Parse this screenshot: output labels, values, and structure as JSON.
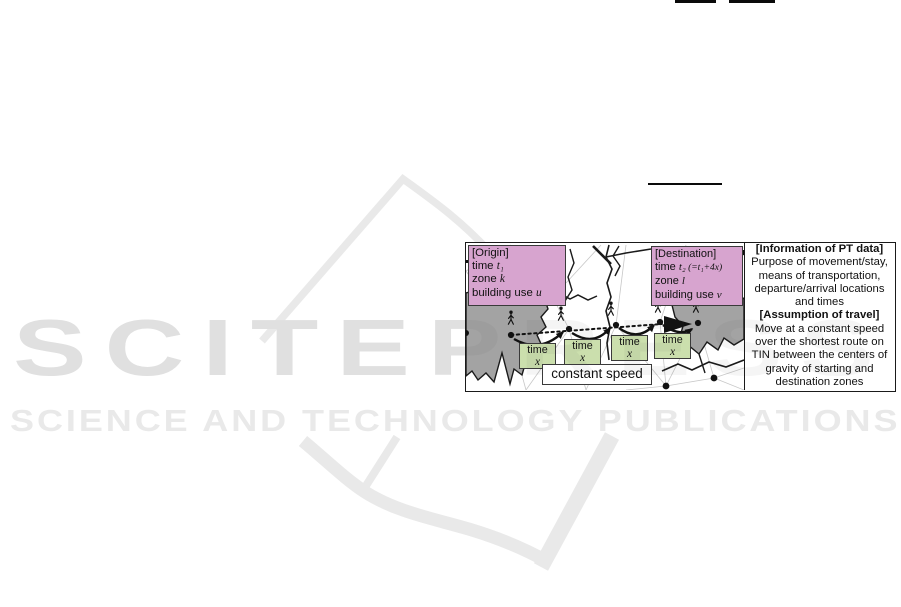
{
  "watermark": {
    "title": "SCITEPRESS",
    "subtitle": "SCIENCE AND TECHNOLOGY PUBLICATIONS",
    "color": "#e9e9e9"
  },
  "figure": {
    "origin_box": {
      "bg": "#d7a4cf",
      "title": "[Origin]",
      "rows": [
        {
          "t": "time ",
          "v": "t₁",
          "x": ""
        },
        {
          "t": "zone ",
          "v": "k",
          "x": ""
        },
        {
          "t": "building use ",
          "v": "u",
          "x": ""
        }
      ]
    },
    "destination_box": {
      "bg": "#d7a4cf",
      "title": "[Destination]",
      "rows": [
        {
          "t": "time ",
          "v": "t₂",
          "x": " (=t₁+4x)"
        },
        {
          "t": "zone ",
          "v": "l",
          "x": ""
        },
        {
          "t": "building use ",
          "v": "v",
          "x": ""
        }
      ]
    },
    "time_boxes": [
      {
        "label": "time",
        "value": "x"
      },
      {
        "label": "time",
        "value": "x"
      },
      {
        "label": "time",
        "value": "x"
      },
      {
        "label": "time",
        "value": "x"
      }
    ],
    "time_box_bg": "#cbdfad",
    "constant_speed_label": "constant speed",
    "info_panel": {
      "heading1": "[Information of PT data]",
      "body1": "Purpose of movement/stay, means of transportation, departure/arrival locations and times",
      "heading2": "[Assumption of travel]",
      "body2": "Move at a constant speed over the shortest route on TIN between the centers of gravity of starting and destination zones"
    },
    "zone_fill": "#a3a3a3"
  }
}
